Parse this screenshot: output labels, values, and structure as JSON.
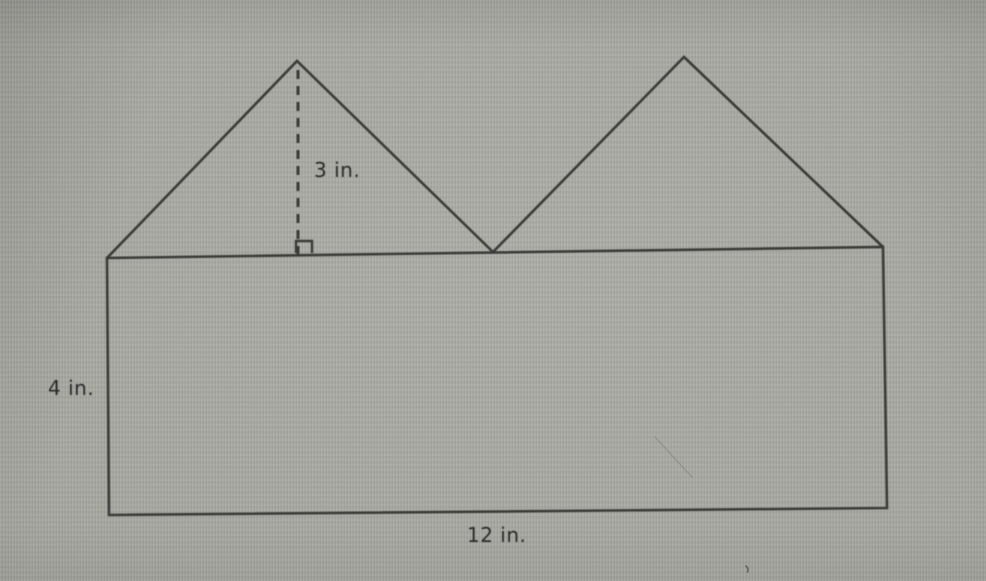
{
  "figure": {
    "type": "composite-geometry-diagram",
    "description": "Rectangle with two congruent triangles on top; triangle height 3 in., rectangle 12 in. wide and 4 in. tall",
    "unit": "in.",
    "measurements": {
      "triangle_height": 3,
      "rectangle_height": 4,
      "rectangle_width": 12
    },
    "labels": {
      "triangle_height": "3 in.",
      "rectangle_height": "4 in.",
      "rectangle_width": "12 in."
    },
    "colors": {
      "background": "#a8a8a2",
      "line": "#3a3a38",
      "text": "#2c2c2a"
    },
    "geometry": {
      "rectangle": [
        [
          107,
          258
        ],
        [
          883,
          247
        ],
        [
          887,
          508
        ],
        [
          109,
          515
        ]
      ],
      "left_triangle": [
        [
          107,
          258
        ],
        [
          297,
          61
        ],
        [
          493,
          252
        ]
      ],
      "right_triangle": [
        [
          493,
          252
        ],
        [
          684,
          57
        ],
        [
          883,
          247
        ]
      ],
      "altitude": [
        [
          298,
          70
        ],
        [
          298,
          254
        ]
      ],
      "right_angle_mark": [
        [
          296,
          253
        ],
        [
          296,
          241
        ],
        [
          312,
          241
        ],
        [
          312,
          253
        ]
      ],
      "scratch": [
        [
          655,
          437
        ],
        [
          678,
          462
        ],
        [
          692,
          477
        ]
      ]
    }
  }
}
